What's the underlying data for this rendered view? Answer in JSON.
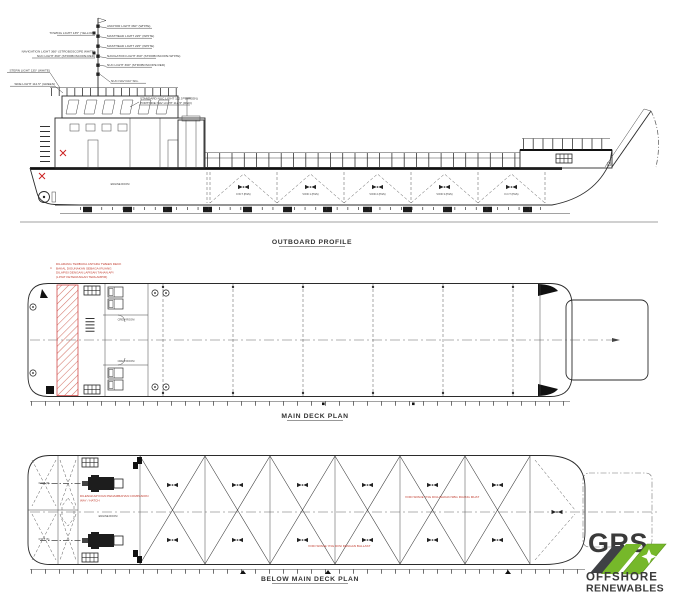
{
  "colors": {
    "line": "#2b2b2b",
    "red_note": "#c0392b",
    "red_hatch": "#d4766a",
    "logo_green": "#76b82a",
    "logo_gray": "#4a4c50",
    "background": "#ffffff"
  },
  "outboard_profile": {
    "title": "OUTBOARD PROFILE",
    "right_light_labels": [
      "ANCHOR LIGHT 360° (WHITE)",
      "MASTHEAD LIGHT 225° (WHITE)",
      "MASTHEAD LIGHT 225° (WHITE)",
      "NAVIGATION LIGHT 360° (STROBOSCOPE WHITE)",
      "NUC LIGHT 360° (STROBOSCOPE RED)",
      "NUC NAV DAY SIG."
    ],
    "left_light_labels": [
      "TOWING LIGHT 135° (YELLOW)",
      "NAVIGATION LIGHT 360° (STROBOSCOPE WHITE)",
      "NUC LIGHT 360° (STROBOSCOPE RED)",
      "STERN LIGHT 135° (WHITE)",
      "SIDE LIGHT 112.5° (GREEN)"
    ],
    "roof_light_labels": [
      "STANDARD NUC LIGHT 112.5° (GREEN)",
      "PORTSIDE NAV LIGHT 112.5° (RED)"
    ],
    "tank_labels": [
      "F.W.T (P&S)",
      "VOID 1 (P&S)",
      "VOID 2 (P&S)",
      "VOID 3 (P&S)",
      "F.O.T (P&S)"
    ],
    "engine_room_label": "ENGINE ROOM"
  },
  "main_deck_plan": {
    "title": "MAIN DECK PLAN",
    "red_note_marker": "4",
    "red_note_lines": [
      "DILARANG TERBUKA ANTARA TWEEN DECK",
      "BAKAL DIGUNAKAN SEBAGAI RUANG",
      "DILAPISI DENGAN LAPISAN TAHAN API",
      "(LIHAT KETERANGAN TERLAMPIR)"
    ],
    "room_labels": [
      "CREW ROOM",
      "CREW ROOM"
    ]
  },
  "below_main_deck_plan": {
    "title": "BELOW MAIN DECK PLAN",
    "red_note_lines": [
      "DILENGKAPI DGN PENAMBAHAN COMPANION",
      "WAY / HATCH"
    ],
    "engine_room_label": "ENGINE ROOM",
    "void_note_1": "VOID SPACE YNG DIGUNAKAN SBG RUANG MUAT",
    "void_note_2": "VOID SPACE YNG DIISI DENGAN BALLAST",
    "stern_tank_labels": [
      "F.W.T (P)",
      "F.W.T (S)"
    ]
  },
  "logo": {
    "name": "GRS",
    "line1": "OFFSHORE",
    "line2": "RENEWABLES"
  }
}
